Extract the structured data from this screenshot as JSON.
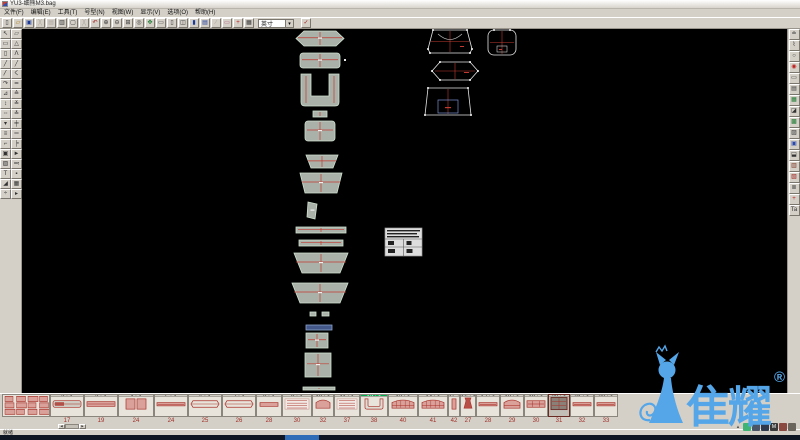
{
  "window": {
    "title": "YU3-细熊M3.bag"
  },
  "menu": [
    "文件(F)",
    "编辑(E)",
    "工具(T)",
    "号型(N)",
    "视图(W)",
    "显示(V)",
    "选项(O)",
    "帮助(H)"
  ],
  "toolbar": {
    "unit": "英寸",
    "confirm": {
      "name": "confirm-button",
      "glyph": "✓",
      "color": "#a02020"
    },
    "buttons": [
      {
        "name": "new",
        "glyph": "▯",
        "color": "#333333",
        "enabled": true
      },
      {
        "name": "open",
        "glyph": "▱",
        "color": "#b07a10",
        "enabled": true
      },
      {
        "name": "save",
        "glyph": "▣",
        "color": "#1a3a9a",
        "enabled": true
      },
      {
        "name": "cut",
        "glyph": "╳",
        "color": "#333333",
        "enabled": false
      },
      {
        "name": "copy",
        "glyph": "▤",
        "color": "#333333",
        "enabled": false
      },
      {
        "name": "print",
        "glyph": "▥",
        "color": "#333333",
        "enabled": true
      },
      {
        "name": "print-preview",
        "glyph": "▢",
        "color": "#333333",
        "enabled": true
      },
      {
        "name": "delete",
        "glyph": "╳",
        "color": "#333333",
        "enabled": false
      },
      {
        "name": "undo",
        "glyph": "↶",
        "color": "#a02020",
        "enabled": true
      },
      {
        "name": "zoom-in",
        "glyph": "⊕",
        "color": "#333333",
        "enabled": true
      },
      {
        "name": "zoom-out",
        "glyph": "⊖",
        "color": "#333333",
        "enabled": true
      },
      {
        "name": "zoom-window",
        "glyph": "⊞",
        "color": "#333333",
        "enabled": true
      },
      {
        "name": "zoom-all",
        "glyph": "◎",
        "color": "#333333",
        "enabled": true
      },
      {
        "name": "pan",
        "glyph": "✥",
        "color": "#1a7a30",
        "enabled": true
      },
      {
        "name": "window-single",
        "glyph": "▭",
        "color": "#333333",
        "enabled": true
      },
      {
        "name": "window-frame",
        "glyph": "▯",
        "color": "#333333",
        "enabled": true
      },
      {
        "name": "window-split",
        "glyph": "◫",
        "color": "#333333",
        "enabled": true
      },
      {
        "name": "window-fill",
        "glyph": "▮",
        "color": "#1a3a9a",
        "enabled": true
      },
      {
        "name": "window-doc",
        "glyph": "▤",
        "color": "#1a3a9a",
        "enabled": true
      },
      {
        "name": "slash",
        "glyph": "∕",
        "color": "#333333",
        "enabled": false
      },
      {
        "name": "measure",
        "glyph": "▭",
        "color": "#b05878",
        "enabled": true
      },
      {
        "name": "plus",
        "glyph": "+",
        "color": "#c02020",
        "enabled": true
      },
      {
        "name": "grid-table",
        "glyph": "▦",
        "color": "#333333",
        "enabled": true
      }
    ]
  },
  "left_toolbar": {
    "tools": [
      "↖",
      "▱",
      "▭",
      "△",
      "▯",
      "Λ",
      "╱",
      "╱",
      "〳",
      "く",
      "↷",
      "≃",
      "⊿",
      "≙",
      "↕",
      "≚",
      "╌",
      "≛",
      "▾",
      "╪",
      "≡",
      "═",
      "⌐",
      "╞",
      "▣",
      "►",
      "▨",
      "≕",
      "T",
      "▪",
      "◢",
      "▦",
      "÷",
      "▸"
    ]
  },
  "right_toolbar": {
    "tools": [
      {
        "glyph": "≐",
        "color": "#333333"
      },
      {
        "glyph": "⌇",
        "color": "#333333"
      },
      {
        "glyph": "○",
        "color": "#333333"
      },
      {
        "glyph": "◉",
        "color": "#c02020"
      },
      {
        "glyph": "▭",
        "color": "#333333"
      },
      {
        "glyph": "▤",
        "color": "#333333"
      },
      {
        "glyph": "▦",
        "color": "#1a7a30"
      },
      {
        "glyph": "◪",
        "color": "#333333"
      },
      {
        "glyph": "▩",
        "color": "#1a7a30"
      },
      {
        "glyph": "▨",
        "color": "#333333"
      },
      {
        "glyph": "▣",
        "color": "#2a4ab0"
      },
      {
        "glyph": "⬓",
        "color": "#333333"
      },
      {
        "glyph": "▥",
        "color": "#7a3020"
      },
      {
        "glyph": "▧",
        "color": "#a02020"
      },
      {
        "glyph": "≣",
        "color": "#333333"
      },
      {
        "glyph": "+",
        "color": "#c02020"
      },
      {
        "glyph": "Ta",
        "color": "#333333"
      }
    ]
  },
  "canvas": {
    "pieces": [
      {
        "t": "hex",
        "x": 274,
        "y": 2,
        "w": 48,
        "h": 15
      },
      {
        "t": "rrect",
        "x": 278,
        "y": 24,
        "w": 40,
        "h": 15
      },
      {
        "t": "u",
        "x": 279,
        "y": 45,
        "w": 38,
        "h": 32
      },
      {
        "t": "rect",
        "x": 291,
        "y": 82,
        "w": 14,
        "h": 6
      },
      {
        "t": "rrect",
        "x": 283,
        "y": 92,
        "w": 30,
        "h": 20
      },
      {
        "t": "cup",
        "x": 284,
        "y": 126,
        "w": 32,
        "h": 13
      },
      {
        "t": "trap",
        "x": 278,
        "y": 144,
        "w": 42,
        "h": 20
      },
      {
        "t": "vstrip",
        "x": 286,
        "y": 173,
        "w": 9,
        "h": 17
      },
      {
        "t": "hstrip",
        "x": 274,
        "y": 198,
        "w": 50,
        "h": 6
      },
      {
        "t": "hstrip",
        "x": 277,
        "y": 211,
        "w": 44,
        "h": 6
      },
      {
        "t": "trapbig",
        "x": 272,
        "y": 224,
        "w": 54,
        "h": 20
      },
      {
        "t": "trapbig",
        "x": 270,
        "y": 254,
        "w": 56,
        "h": 20
      },
      {
        "t": "rect",
        "x": 288,
        "y": 283,
        "w": 6,
        "h": 4
      },
      {
        "t": "rect",
        "x": 300,
        "y": 283,
        "w": 7,
        "h": 4
      },
      {
        "t": "blue",
        "x": 284,
        "y": 296,
        "w": 26,
        "h": 5
      },
      {
        "t": "rect",
        "x": 284,
        "y": 304,
        "w": 22,
        "h": 15
      },
      {
        "t": "rect",
        "x": 283,
        "y": 324,
        "w": 26,
        "h": 24
      },
      {
        "t": "hstrip",
        "x": 281,
        "y": 358,
        "w": 32,
        "h": 3
      }
    ],
    "outlines": [
      {
        "t": "trapA",
        "x": 406,
        "y": 1,
        "w": 44,
        "h": 23
      },
      {
        "t": "roundB",
        "x": 466,
        "y": 1,
        "w": 28,
        "h": 25
      },
      {
        "t": "hexC",
        "x": 410,
        "y": 33,
        "w": 46,
        "h": 18
      },
      {
        "t": "trapD",
        "x": 403,
        "y": 59,
        "w": 46,
        "h": 27
      }
    ],
    "info_table": {
      "x": 363,
      "y": 199,
      "w": 37,
      "h": 28
    }
  },
  "strip": {
    "cells": [
      {
        "h": "",
        "n": "",
        "w": 48,
        "t": "cluster"
      },
      {
        "h": "2 : 1",
        "n": "17",
        "w": 34,
        "t": "panelbar"
      },
      {
        "h": "3 : 1",
        "n": "19",
        "w": 34,
        "t": "bar"
      },
      {
        "h": "4 : 1",
        "n": "24",
        "w": 36,
        "t": "panels"
      },
      {
        "h": "5 : 1",
        "n": "24",
        "w": 34,
        "t": "thinbar"
      },
      {
        "h": "6 : 1",
        "n": "25",
        "w": 34,
        "t": "capsule"
      },
      {
        "h": "7 : 1",
        "n": "26",
        "w": 34,
        "t": "capsule"
      },
      {
        "h": "8 : 1",
        "n": "28",
        "w": 26,
        "t": "smallbar"
      },
      {
        "h": "9 : 1",
        "n": "30",
        "w": 30,
        "t": "textblock"
      },
      {
        "h": "10 : 1",
        "n": "32",
        "w": 22,
        "t": "smalldome"
      },
      {
        "h": "11 : 1",
        "n": "37",
        "w": 26,
        "t": "textblock"
      },
      {
        "h": "12 : 1",
        "n": "38",
        "w": 28,
        "t": "ushape",
        "g": true
      },
      {
        "h": "13 : 1",
        "n": "40",
        "w": 30,
        "t": "domegrid"
      },
      {
        "h": "14 : 1",
        "n": "41",
        "w": 30,
        "t": "domegrid"
      },
      {
        "h": "15 : 1",
        "n": "42",
        "w": 12,
        "t": "vbar"
      },
      {
        "h": "16 : 1",
        "n": "27",
        "w": 16,
        "t": "tie"
      },
      {
        "h": "17 : 1",
        "n": "28",
        "w": 24,
        "t": "thinbar"
      },
      {
        "h": "18 : 1",
        "n": "29",
        "w": 24,
        "t": "dome"
      },
      {
        "h": "19 : 1",
        "n": "30",
        "w": 24,
        "t": "hexbar"
      },
      {
        "h": "20 : 1",
        "n": "31",
        "w": 22,
        "t": "darkgrid",
        "s": true
      },
      {
        "h": "21 : 1",
        "n": "32",
        "w": 24,
        "t": "thinbar"
      },
      {
        "h": "22 : 1",
        "n": "33",
        "w": 24,
        "t": "thinbar"
      }
    ]
  },
  "scrollbar": {
    "left": "◀",
    "right": "▶"
  },
  "status": {
    "text": "就绪"
  },
  "tray": {
    "icons": [
      {
        "name": "tray-expand-icon",
        "glyph": "▴",
        "bg": "transparent",
        "color": "#555555"
      },
      {
        "name": "wechat-icon",
        "glyph": "",
        "bg": "#3eb575",
        "color": "#ffffff"
      },
      {
        "name": "tray-app-icon",
        "glyph": "",
        "bg": "#4a5668",
        "color": "#ffffff"
      },
      {
        "name": "tray-app-icon",
        "glyph": "",
        "bg": "#2f3b4c",
        "color": "#ffffff"
      },
      {
        "name": "input-method-icon",
        "glyph": "M",
        "bg": "#3a3a3a",
        "color": "#ffffff"
      },
      {
        "name": "tray-app-icon",
        "glyph": "",
        "bg": "#8a4a42",
        "color": "#ffffff"
      },
      {
        "name": "tray-app-icon",
        "glyph": "",
        "bg": "#6a665e",
        "color": "#ffffff"
      }
    ]
  },
  "watermark": {
    "text": "隹耀",
    "registered": "®"
  },
  "colors": {
    "canvas_bg": "#000000",
    "piece_fill": "#a9b1a8",
    "piece_outline": "#cfe0cf",
    "inner_line_red": "#c23a30",
    "thumb_red": "#a83028",
    "selection_green": "#00b050",
    "watermark_blue": "#55a6e8",
    "taskbar": "#0e1624",
    "taskbar_active": "#2e6cb8"
  }
}
